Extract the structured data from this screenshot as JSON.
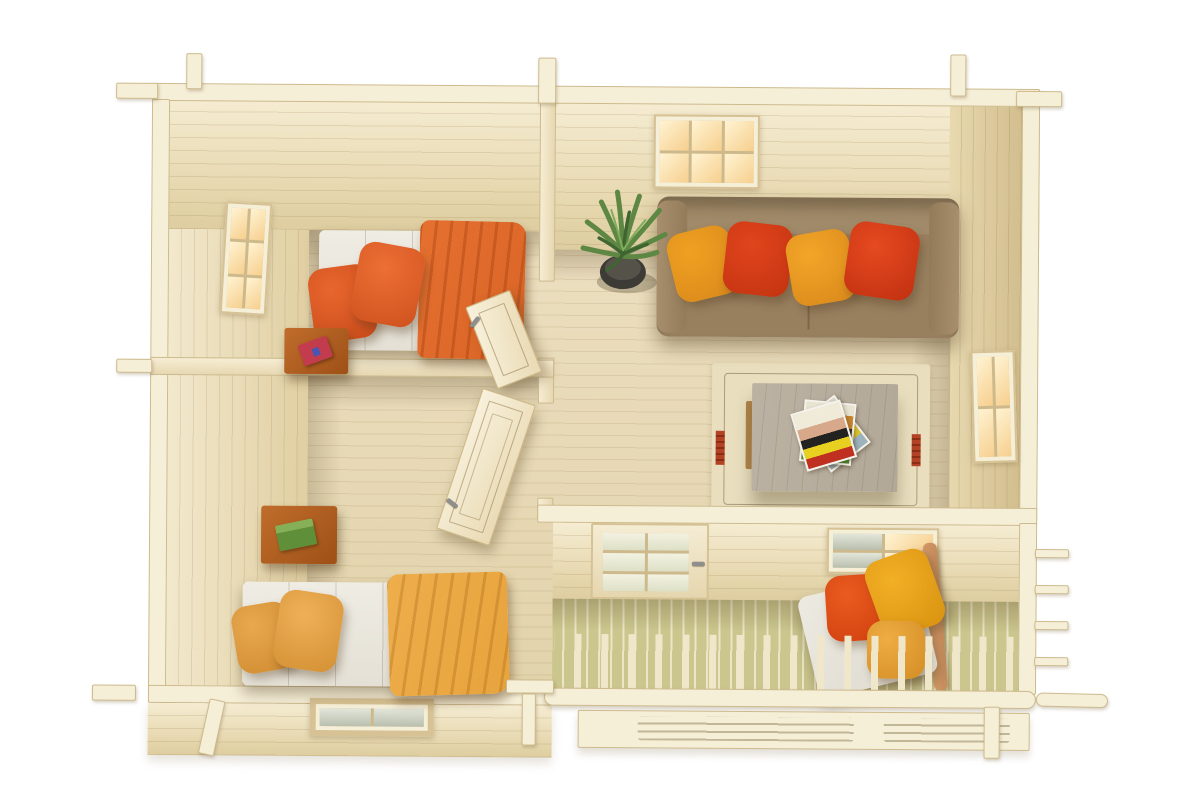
{
  "scene": {
    "subject": "top-down 3D render of a wooden log cabin interior with terrace",
    "background": "white",
    "rooms": [
      {
        "name": "bedroom-upper-left",
        "floor": "light pine planks",
        "items": [
          {
            "name": "single-bed",
            "details": [
              "white mattress",
              "two orange pillows",
              "orange throw blanket draped at foot"
            ]
          },
          {
            "name": "bedside-table",
            "details": [
              "cherry wood",
              "red book with blue bookmark"
            ]
          },
          {
            "name": "side-window",
            "wall": "left",
            "panes": 6,
            "light": "warm sunlight"
          },
          {
            "name": "interior-door",
            "state": "open into room"
          }
        ]
      },
      {
        "name": "bedroom-lower-left",
        "floor": "light pine planks",
        "items": [
          {
            "name": "single-bed",
            "details": [
              "grey-white mattress",
              "two amber pillows",
              "amber throw blanket draped at foot"
            ]
          },
          {
            "name": "bedside-table",
            "details": [
              "cherry wood",
              "green book"
            ]
          },
          {
            "name": "front-window",
            "wall": "bottom exterior",
            "panes": 2
          },
          {
            "name": "interior-door",
            "state": "open into room"
          }
        ]
      },
      {
        "name": "living-room",
        "floor": "light pine planks",
        "items": [
          {
            "name": "sofa",
            "seats": 3,
            "color": "taupe brown",
            "pillows": [
              "amber",
              "red",
              "amber",
              "red"
            ]
          },
          {
            "name": "potted-plant",
            "details": [
              "dark round pot",
              "spiky green leaves"
            ]
          },
          {
            "name": "coffee-table",
            "details": [
              "grey washed wood",
              "stack of magazines"
            ]
          },
          {
            "name": "area-rug",
            "details": [
              "beige",
              "thin dark border line",
              "red tassel marks left and right"
            ]
          },
          {
            "name": "top-wall-window",
            "panes": 6,
            "light": "warm sunlight"
          },
          {
            "name": "right-wall-window",
            "panes": 4,
            "light": "warm sunlight"
          },
          {
            "name": "front-wall-window",
            "panes": 4
          },
          {
            "name": "glazed-terrace-door",
            "state": "closed",
            "panes": 6,
            "handle": "grey metal"
          }
        ]
      },
      {
        "name": "terrace",
        "floor": "pale green deck boards",
        "items": [
          {
            "name": "lounge-chair",
            "details": [
              "white cushion",
              "red-orange pillow",
              "two amber pillows",
              "wooden frame rail"
            ]
          },
          {
            "name": "front-railing",
            "details": [
              "top rail",
              "vertical balusters"
            ]
          },
          {
            "name": "side-railing"
          },
          {
            "name": "front-step-bench",
            "details": [
              "slotted planks"
            ]
          }
        ]
      }
    ],
    "construction": [
      "interlocking log corner joints protruding at corners",
      "interior partition walls",
      "two open panel doors with metal handles"
    ]
  },
  "palette": {
    "bg": "#ffffff",
    "wall-cap": "#f6efd8",
    "wall-line": "#cdbb8e",
    "floor": "#ecdfc0",
    "glass-warm": "#f6cf8e",
    "glass-cool": "#b9bfae",
    "deck": "#cbc68e",
    "deck-gap": "#ebe7c6",
    "sofa": "#98805f",
    "pillow-red": "#e0451d",
    "pillow-amber": "#efa122",
    "blanket-orange": "#d96426",
    "blanket-amber": "#e7a33c",
    "mattress": "#e6e2d8",
    "wood-cherry": "#9e5016",
    "table-grey": "#b2a898",
    "rug": "#e9dfbf",
    "plant-green": "#5d8743",
    "pot-dark": "#3d3b36",
    "chair-wood": "#c68c5c"
  }
}
